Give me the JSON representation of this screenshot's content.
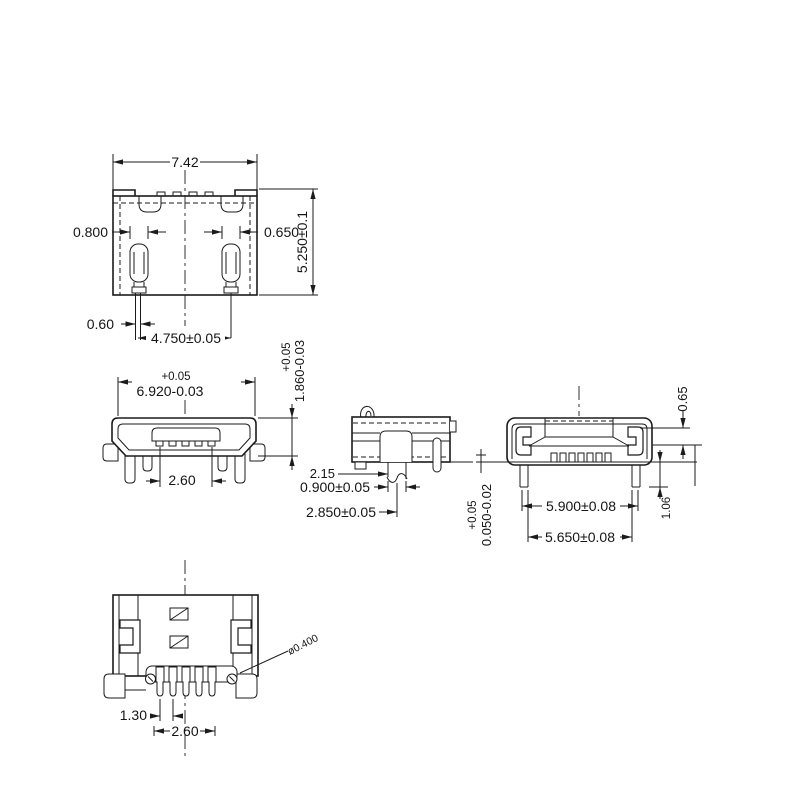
{
  "drawing": {
    "background": "#ffffff",
    "line_color": "#1b1b1b",
    "views": {
      "top": {
        "name": "top-view",
        "dims": {
          "overall_width": "7.42",
          "left_contact_width": "0.800",
          "right_contact_width": "0.650",
          "overall_depth": "5.250±0.1",
          "lead_width": "0.60",
          "lead_span": "4.750±0.05"
        }
      },
      "front": {
        "name": "front-view",
        "dims": {
          "width_tol": "+0.05",
          "width": "6.920-0.03",
          "height_tol": "+0.05",
          "height": "1.860-0.03",
          "contact_span": "2.60"
        }
      },
      "side": {
        "name": "side-view",
        "dims": {
          "offset": "2.15",
          "leg_width": "0.900±0.05",
          "leg_offset": "2.850±0.05"
        }
      },
      "rear": {
        "name": "rear-view",
        "dims": {
          "shell_step": "0.65",
          "standoff_tol": "+0.05",
          "standoff": "0.050-0.02",
          "leg_span_outer": "5.900±0.08",
          "leg_span_inner": "5.650±0.08",
          "leg_length": "1.06"
        }
      },
      "bottom": {
        "name": "bottom-view",
        "dims": {
          "pin_pitch": "1.30",
          "pin_span": "2.60",
          "pin_diameter": "ø0.400"
        }
      }
    }
  }
}
